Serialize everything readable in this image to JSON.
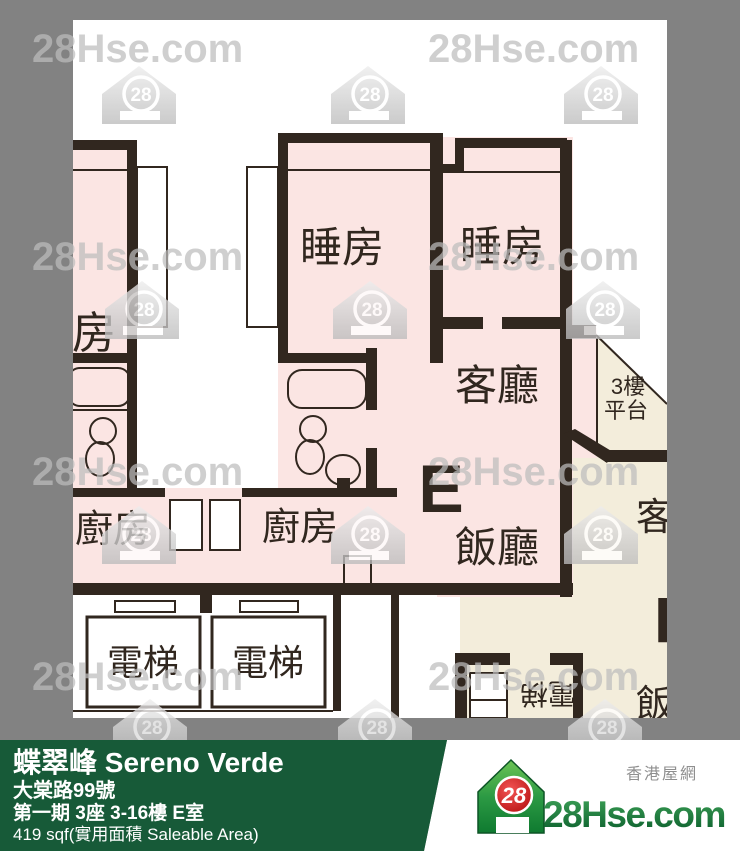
{
  "watermark": {
    "site": "28Hse.com",
    "logo_number": "28"
  },
  "plan": {
    "unit_letter": "E",
    "labels": {
      "bedroom_left": "睡房",
      "bedroom_1": "睡房",
      "bedroom_2": "睡房",
      "living": "客廳",
      "dining": "飯廳",
      "kitchen_left": "廚房",
      "kitchen_mid": "廚房",
      "lift_1": "電梯",
      "lift_2": "電梯",
      "platform_line1": "3樓",
      "platform_line2": "平台",
      "neighbor_living": "客廳",
      "neighbor_unit_letter": "F",
      "neighbor_dining": "飯廳",
      "neighbor_lift": "電梯"
    }
  },
  "footer": {
    "building_name": "蝶翠峰 Sereno Verde",
    "address": "大棠路99號",
    "unit_info": "第一期 3座 3-16樓 E室",
    "area": "419 sqf(實用面積 Saleable Area)"
  },
  "brand": {
    "site_chinese": "香港屋網",
    "name": "28Hse.com",
    "logo_number": "28"
  },
  "colors": {
    "background": "#828282",
    "plan_white": "#ffffff",
    "room_pink": "#fbe5e3",
    "room_beige": "#f3eddb",
    "wall": "#31271f",
    "footer_green": "#175a38",
    "brand_green": "#1b7a3e",
    "brand_red": "#c41414",
    "watermark_gray": "#bdbdbd"
  }
}
